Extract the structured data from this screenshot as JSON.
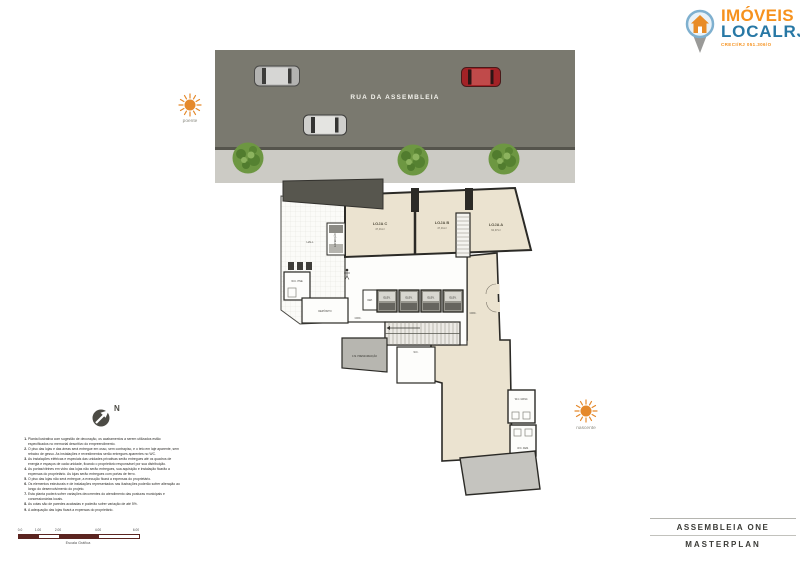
{
  "logo": {
    "line1": "IMÓVEIS",
    "line2": "LOCALRJ",
    "subtext": "CRECI/RJ 051.306/O"
  },
  "street": {
    "name": "RUA DA ASSEMBLEIA"
  },
  "orientation": {
    "west": "poente",
    "east": "nascente",
    "north": "N"
  },
  "plan": {
    "rooms": {
      "hall": "HALL",
      "expedicao": "EXPEDIÇÃO",
      "wc_pne": "W.C. PNE",
      "deposito": "DEPÓSITO",
      "dep": "DEP.",
      "elev": "ELEV.",
      "circ": "CIRC.",
      "cm_press": "C.M. PRESSURIZAÇÃO",
      "wc": "W.C.",
      "wc_masc": "W.C. MASC.",
      "wc_fem": "W.C. FEM."
    },
    "lojas": [
      {
        "name": "LOJA C",
        "area": "47,31m²"
      },
      {
        "name": "LOJA B",
        "area": "47,31m²"
      },
      {
        "name": "LOJA A",
        "area": "62,97m²"
      }
    ]
  },
  "notes": {
    "items": [
      "Planta ilustrativa com sugestão de decoração, os acabamentos a serem utilizados estão especificados no memorial descritivo do empreendimento.",
      "O piso das lojas e das áreas será entregue em osso, sem contrapiso, e o teto em laje aparente, sem rebaixo de gesso. As instalações e revestimentos serão entregues aparentes no WC.",
      "As instalações elétricas e especiais das unidades privativas serão entregues até os quadros de energia e espaços de cada unidade, ficando o proprietário responsável por sua distribuição.",
      "As portas/vitrines em vidro das lojas não serão entregues, sua aquisição e instalação ficarão a expensas do proprietário. As lojas serão entregues com portas de ferro.",
      "O piso das lojas não será entregue, a execução ficará a expensas do proprietário.",
      "Os elementos estruturais e de instalações representados nas ilustrações poderão sofrer alteração ao longo do desenvolvimento do projeto.",
      "Esta planta poderá sofrer variações decorrentes do atendimento das posturas municipais e concessionárias locais.",
      "As cotas são de paredes acabadas e poderão sofrer variação de até 5%.",
      "A adequação das lojas ficará a expensas do proprietário."
    ]
  },
  "scale": {
    "ticks": [
      "0.0",
      "1.00",
      "2.00",
      "4.00",
      "6.00"
    ],
    "label": "Escala Gráfica"
  },
  "title_block": {
    "project": "ASSEMBLEIA ONE",
    "sheet": "MASTERPLAN"
  },
  "colors": {
    "accent_orange": "#f6921e",
    "accent_blue": "#2878a5",
    "plan_beige": "#ebe3d0",
    "asphalt": "#7a796f"
  }
}
